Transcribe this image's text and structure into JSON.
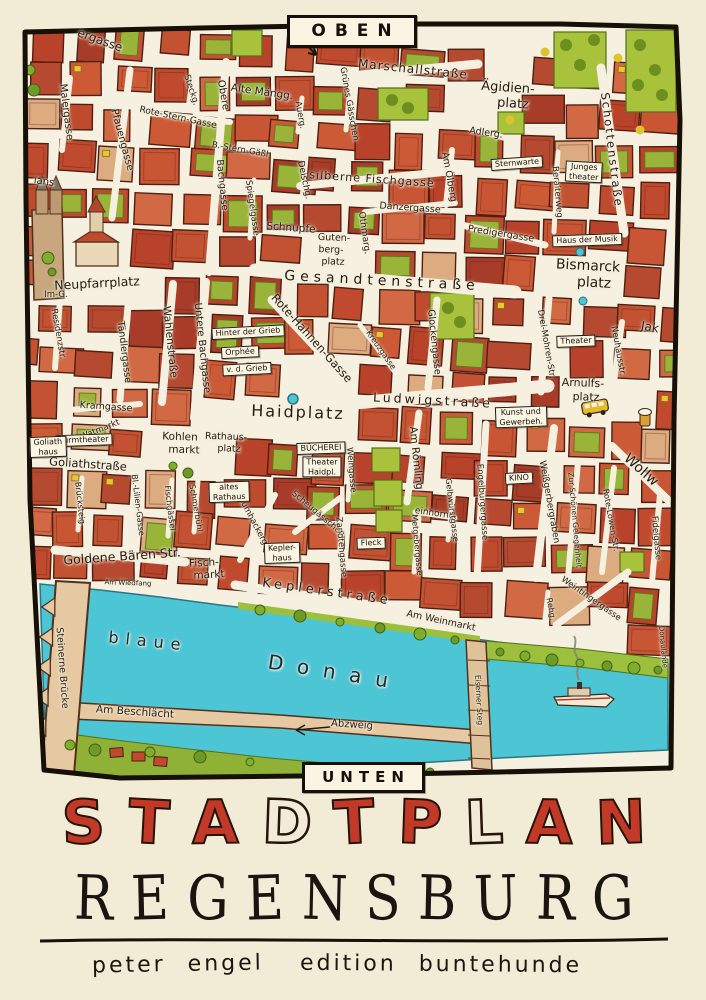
{
  "poster": {
    "orientation_top": "OBEN",
    "orientation_bottom": "UNTEN",
    "title": "STADTPLAN",
    "title_letters": [
      {
        "ch": "S",
        "fill": "red"
      },
      {
        "ch": "T",
        "fill": "red"
      },
      {
        "ch": "A",
        "fill": "red"
      },
      {
        "ch": "D",
        "fill": "outline"
      },
      {
        "ch": "T",
        "fill": "red"
      },
      {
        "ch": "P",
        "fill": "red"
      },
      {
        "ch": "L",
        "fill": "outline"
      },
      {
        "ch": "A",
        "fill": "red"
      },
      {
        "ch": "N",
        "fill": "red"
      }
    ],
    "subtitle": "REGENSBURG",
    "subtitle_letters": [
      "R",
      "E",
      "G",
      "E",
      "N",
      "S",
      "B",
      "U",
      "R",
      "G"
    ],
    "author": "peter engel",
    "publisher": "edition buntehunde",
    "colors": {
      "title_red": "#c23a27",
      "ink": "#241a0e",
      "paper": "#f6f0e0",
      "margin": "#f2ecd6",
      "river": "#4cc5d5",
      "building_red": "#c04a2e",
      "park_green": "#a8c23c",
      "bridge_tan": "#e6c9a2"
    }
  },
  "map": {
    "river_name_words": [
      "blaue",
      "Donau"
    ],
    "street_labels": [
      {
        "t": "ergasse",
        "x": 100,
        "y": 40,
        "r": 20,
        "s": 12
      },
      {
        "t": "Malergasse",
        "x": 66,
        "y": 112,
        "r": 83,
        "s": 10
      },
      {
        "t": "Pfauengasse",
        "x": 122,
        "y": 140,
        "r": 75,
        "s": 10
      },
      {
        "t": "ians",
        "x": 44,
        "y": 182,
        "r": 8,
        "s": 10
      },
      {
        "t": "Rote-Stern-Gasse",
        "x": 178,
        "y": 118,
        "r": 12,
        "s": 9
      },
      {
        "t": "B.-Stern-Gäßl",
        "x": 240,
        "y": 150,
        "r": 10,
        "s": 8.5
      },
      {
        "t": "Steckg.",
        "x": 191,
        "y": 90,
        "r": 72,
        "s": 8.5
      },
      {
        "t": "Obere",
        "x": 223,
        "y": 95,
        "r": 80,
        "s": 10
      },
      {
        "t": "Bachgasse",
        "x": 222,
        "y": 185,
        "r": 84,
        "s": 9.5
      },
      {
        "t": "Alte Mängg.",
        "x": 262,
        "y": 92,
        "r": 8,
        "s": 10.5
      },
      {
        "t": "Auerg.",
        "x": 300,
        "y": 115,
        "r": 80,
        "s": 8.5
      },
      {
        "t": "Marschallstraße",
        "x": 413,
        "y": 69,
        "r": 6,
        "s": 12,
        "sp": 1
      },
      {
        "t": "Grünes Gässchen",
        "x": 349,
        "y": 104,
        "r": 80,
        "s": 8.5
      },
      {
        "t": "Ägidien-",
        "x": 508,
        "y": 88,
        "r": 4,
        "s": 13
      },
      {
        "t": "platz",
        "x": 513,
        "y": 104,
        "r": 4,
        "s": 13
      },
      {
        "t": "Adlerg.",
        "x": 486,
        "y": 133,
        "r": 8,
        "s": 9.5
      },
      {
        "t": "silberne Fischgasse",
        "x": 372,
        "y": 179,
        "r": 4,
        "s": 11,
        "sp": 1
      },
      {
        "t": "Othmarg.",
        "x": 364,
        "y": 233,
        "r": 82,
        "s": 9
      },
      {
        "t": "Am Ölberg",
        "x": 449,
        "y": 177,
        "r": 80,
        "s": 9.5
      },
      {
        "t": "Dänzergasse",
        "x": 410,
        "y": 208,
        "r": 4,
        "s": 9.5
      },
      {
        "t": "Predigergasse",
        "x": 501,
        "y": 234,
        "r": 9,
        "s": 9.5
      },
      {
        "t": "Schottenstraße",
        "x": 612,
        "y": 150,
        "r": 83,
        "s": 11.5,
        "sp": 2
      },
      {
        "t": "Beraiterweg",
        "x": 557,
        "y": 192,
        "r": 85,
        "s": 8.5
      },
      {
        "t": "Bismarck",
        "x": 588,
        "y": 266,
        "r": 3,
        "s": 14
      },
      {
        "t": "platz",
        "x": 594,
        "y": 283,
        "r": 3,
        "s": 14
      },
      {
        "t": "Spiegelgasse",
        "x": 252,
        "y": 208,
        "r": 82,
        "s": 8.5
      },
      {
        "t": "Deischg.",
        "x": 304,
        "y": 180,
        "r": 78,
        "s": 9
      },
      {
        "t": "Schnupfe",
        "x": 291,
        "y": 228,
        "r": 4,
        "s": 10.5
      },
      {
        "t": "Guten-",
        "x": 334,
        "y": 238,
        "r": 2,
        "s": 9.5
      },
      {
        "t": "berg-",
        "x": 331,
        "y": 250,
        "r": 2,
        "s": 9.5
      },
      {
        "t": "platz",
        "x": 333,
        "y": 262,
        "r": 2,
        "s": 9.5
      },
      {
        "t": "Gesandtenstraße",
        "x": 382,
        "y": 281,
        "r": 3,
        "s": 14,
        "sp": 5
      },
      {
        "t": "Neupfarrplatz",
        "x": 97,
        "y": 283,
        "r": -3,
        "s": 12.5
      },
      {
        "t": "Im-G.",
        "x": 56,
        "y": 295,
        "r": 0,
        "s": 8.5
      },
      {
        "t": "Residenzstr.",
        "x": 58,
        "y": 334,
        "r": 80,
        "s": 8.5
      },
      {
        "t": "Tändlergasse",
        "x": 124,
        "y": 352,
        "r": 83,
        "s": 9.5
      },
      {
        "t": "Wahlenstraße",
        "x": 170,
        "y": 342,
        "r": 84,
        "s": 10.5
      },
      {
        "t": "Untere Bachgasse",
        "x": 202,
        "y": 348,
        "r": 84,
        "s": 10
      },
      {
        "t": "Kramgasse",
        "x": 106,
        "y": 407,
        "r": 4,
        "s": 9.5
      },
      {
        "t": "Rote-Hahnen-Gasse",
        "x": 312,
        "y": 338,
        "r": 48,
        "s": 11.5
      },
      {
        "t": "Kreuzgasse",
        "x": 381,
        "y": 350,
        "r": 55,
        "s": 8
      },
      {
        "t": "Glockengasse",
        "x": 434,
        "y": 342,
        "r": 84,
        "s": 9.5
      },
      {
        "t": "Haidplatz",
        "x": 298,
        "y": 412,
        "r": 2,
        "s": 16,
        "sp": 2
      },
      {
        "t": "Ludwigstraße",
        "x": 433,
        "y": 400,
        "r": 3,
        "s": 12.5,
        "sp": 3
      },
      {
        "t": "Am Römling",
        "x": 416,
        "y": 458,
        "r": 84,
        "s": 10.5
      },
      {
        "t": "Drei-Mohren-Str.",
        "x": 546,
        "y": 344,
        "r": 80,
        "s": 8.5
      },
      {
        "t": "Neuhausstr.",
        "x": 618,
        "y": 351,
        "r": 80,
        "s": 8.5
      },
      {
        "t": "Jak",
        "x": 650,
        "y": 327,
        "r": 10,
        "s": 12
      },
      {
        "t": "Arnulfs-",
        "x": 583,
        "y": 383,
        "r": 2,
        "s": 11
      },
      {
        "t": "platz",
        "x": 586,
        "y": 397,
        "r": 2,
        "s": 11
      },
      {
        "t": "Watmarkt",
        "x": 100,
        "y": 430,
        "r": -22,
        "s": 8.5
      },
      {
        "t": "Goliathstraße",
        "x": 88,
        "y": 464,
        "r": 4,
        "s": 11.5
      },
      {
        "t": "Kohlen",
        "x": 180,
        "y": 437,
        "r": 2,
        "s": 10.5
      },
      {
        "t": "markt",
        "x": 184,
        "y": 450,
        "r": 2,
        "s": 10.5
      },
      {
        "t": "Rathaus-",
        "x": 226,
        "y": 437,
        "r": 2,
        "s": 9.5
      },
      {
        "t": "platz",
        "x": 229,
        "y": 449,
        "r": 2,
        "s": 9.5
      },
      {
        "t": "Brücksteig",
        "x": 80,
        "y": 503,
        "r": 84,
        "s": 8
      },
      {
        "t": "Bl.-Lilien-Gasse",
        "x": 138,
        "y": 505,
        "r": 83,
        "s": 8
      },
      {
        "t": "Fischgässel",
        "x": 170,
        "y": 508,
        "r": 83,
        "s": 8
      },
      {
        "t": "Schmerbühl",
        "x": 196,
        "y": 508,
        "r": 80,
        "s": 8
      },
      {
        "t": "Goldene Bären Str.",
        "x": 122,
        "y": 556,
        "r": -4,
        "s": 12.5
      },
      {
        "t": "Fisch-",
        "x": 204,
        "y": 563,
        "r": -3,
        "s": 10.5
      },
      {
        "t": "markt",
        "x": 209,
        "y": 575,
        "r": -3,
        "s": 10.5
      },
      {
        "t": "Baumhackergasse",
        "x": 256,
        "y": 527,
        "r": 62,
        "s": 8.5
      },
      {
        "t": "Scheugässchen",
        "x": 318,
        "y": 514,
        "r": 40,
        "s": 8.5
      },
      {
        "t": "Zandtengasse",
        "x": 341,
        "y": 547,
        "r": 85,
        "s": 8.5
      },
      {
        "t": "Weingasse",
        "x": 351,
        "y": 470,
        "r": 85,
        "s": 8.5
      },
      {
        "t": "einhorng.",
        "x": 436,
        "y": 514,
        "r": 8,
        "s": 9
      },
      {
        "t": "Metgebergasse",
        "x": 417,
        "y": 545,
        "r": 85,
        "s": 8
      },
      {
        "t": "Gelbwürstgasse",
        "x": 452,
        "y": 510,
        "r": 83,
        "s": 8
      },
      {
        "t": "Keplerstraße",
        "x": 327,
        "y": 592,
        "r": 8,
        "s": 13,
        "sp": 4
      },
      {
        "t": "Am Weinmarkt",
        "x": 441,
        "y": 621,
        "r": 12,
        "s": 9.5
      },
      {
        "t": "Engelburgergasse",
        "x": 482,
        "y": 502,
        "r": 86,
        "s": 8.5
      },
      {
        "t": "Weißgerbergraben",
        "x": 549,
        "y": 502,
        "r": 80,
        "s": 9
      },
      {
        "t": "Zur Schönen Gelegenheit",
        "x": 575,
        "y": 520,
        "r": 85,
        "s": 7.5
      },
      {
        "t": "Rote-Löwen-Str.",
        "x": 611,
        "y": 520,
        "r": 80,
        "s": 8
      },
      {
        "t": "Wollw",
        "x": 641,
        "y": 470,
        "r": 42,
        "s": 14
      },
      {
        "t": "Fidelgasse",
        "x": 656,
        "y": 538,
        "r": 85,
        "s": 8.5
      },
      {
        "t": "Rehg.",
        "x": 551,
        "y": 609,
        "r": 80,
        "s": 8
      },
      {
        "t": "Weintingergasse",
        "x": 591,
        "y": 599,
        "r": 35,
        "s": 8.5
      },
      {
        "t": "Donaulände",
        "x": 663,
        "y": 647,
        "r": 85,
        "s": 7
      },
      {
        "t": "Am Wiedfang",
        "x": 128,
        "y": 583,
        "r": 2,
        "s": 7
      },
      {
        "t": "Steinerne Brücke",
        "x": 62,
        "y": 668,
        "r": 86,
        "s": 9.5
      },
      {
        "t": "Am Beschlächt",
        "x": 135,
        "y": 712,
        "r": 4,
        "s": 10.5
      },
      {
        "t": "blaue",
        "x": 148,
        "y": 641,
        "r": 6,
        "s": 16,
        "sp": 7,
        "c": "water"
      },
      {
        "t": "Donau",
        "x": 335,
        "y": 672,
        "r": 9,
        "s": 20,
        "sp": 14,
        "c": "water"
      },
      {
        "t": "Abzweig",
        "x": 352,
        "y": 725,
        "r": 4,
        "s": 10
      },
      {
        "t": "Eiserner Steg",
        "x": 479,
        "y": 700,
        "r": 87,
        "s": 7.5
      }
    ],
    "place_signs": [
      {
        "lines": [
          "Sternwarte"
        ],
        "x": 517,
        "y": 163,
        "r": -4
      },
      {
        "lines": [
          "Junges",
          "theater"
        ],
        "x": 584,
        "y": 172,
        "r": 3
      },
      {
        "lines": [
          "Haus der Musik"
        ],
        "x": 587,
        "y": 240,
        "r": -2
      },
      {
        "lines": [
          "Theater"
        ],
        "x": 576,
        "y": 341,
        "r": -2
      },
      {
        "lines": [
          "BÜCHEREI"
        ],
        "x": 321,
        "y": 448,
        "r": -2
      },
      {
        "lines": [
          "Theater",
          "Haidpl."
        ],
        "x": 322,
        "y": 467,
        "r": 0
      },
      {
        "lines": [
          "Kepler-",
          "haus"
        ],
        "x": 282,
        "y": 553,
        "r": -2
      },
      {
        "lines": [
          "Fleck"
        ],
        "x": 371,
        "y": 543,
        "r": -2
      },
      {
        "lines": [
          "KINO"
        ],
        "x": 519,
        "y": 478,
        "r": -3
      },
      {
        "lines": [
          "Turmtheater"
        ],
        "x": 84,
        "y": 440,
        "r": -2
      },
      {
        "lines": [
          "Goliath",
          "haus"
        ],
        "x": 48,
        "y": 447,
        "r": -2
      },
      {
        "lines": [
          "altes",
          "Rathaus"
        ],
        "x": 229,
        "y": 492,
        "r": -2
      },
      {
        "lines": [
          "Kunst und",
          "Gewerbeh."
        ],
        "x": 521,
        "y": 417,
        "r": -2
      },
      {
        "lines": [
          "Hinter der Grieb"
        ],
        "x": 248,
        "y": 332,
        "r": -3
      },
      {
        "lines": [
          "Orphée"
        ],
        "x": 240,
        "y": 352,
        "r": -3
      },
      {
        "lines": [
          "v. d. Grieb"
        ],
        "x": 247,
        "y": 369,
        "r": -3
      }
    ]
  }
}
